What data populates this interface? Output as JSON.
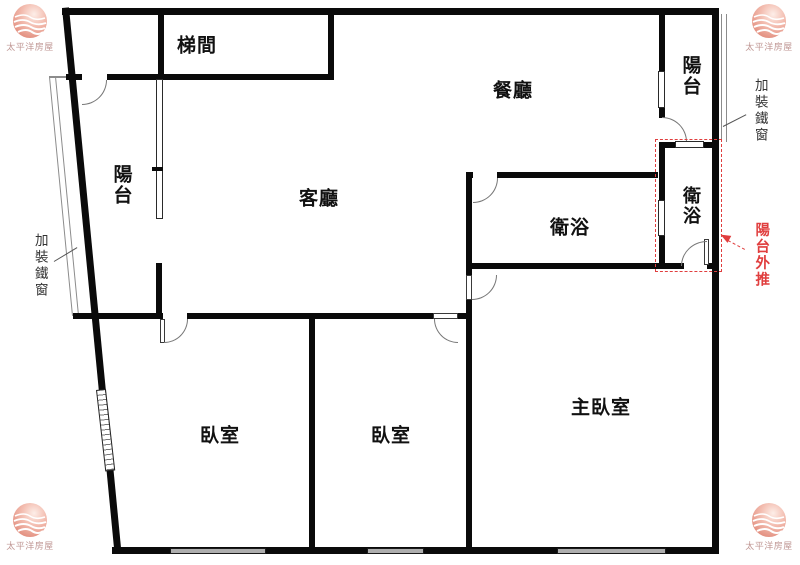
{
  "plan": {
    "rooms": [
      {
        "id": "stairwell",
        "label": "梯間"
      },
      {
        "id": "dining",
        "label": "餐廳"
      },
      {
        "id": "living",
        "label": "客廳"
      },
      {
        "id": "balcony_left",
        "label": "陽台"
      },
      {
        "id": "balcony_right",
        "label": "陽台"
      },
      {
        "id": "bath_left",
        "label": "衛浴"
      },
      {
        "id": "bath_right",
        "label": "衛浴"
      },
      {
        "id": "bedroom_left",
        "label": "臥室"
      },
      {
        "id": "bedroom_center",
        "label": "臥室"
      },
      {
        "id": "master_bedroom",
        "label": "主臥室"
      }
    ],
    "annotations": [
      {
        "id": "iron_window_left",
        "label": "加裝鐵窗",
        "color": "#333333"
      },
      {
        "id": "iron_window_right",
        "label": "加裝鐵窗",
        "color": "#333333"
      },
      {
        "id": "balcony_pushout",
        "label": "陽台外推",
        "color": "#e03e3e"
      }
    ],
    "logo": {
      "text": "太平洋房屋"
    },
    "colors": {
      "wall": "#0a0a0a",
      "annotation_red": "#e03e3e",
      "window_gray": "#aeaeae",
      "logo_pink": "#eba091",
      "logo_text": "#bf9693"
    }
  }
}
